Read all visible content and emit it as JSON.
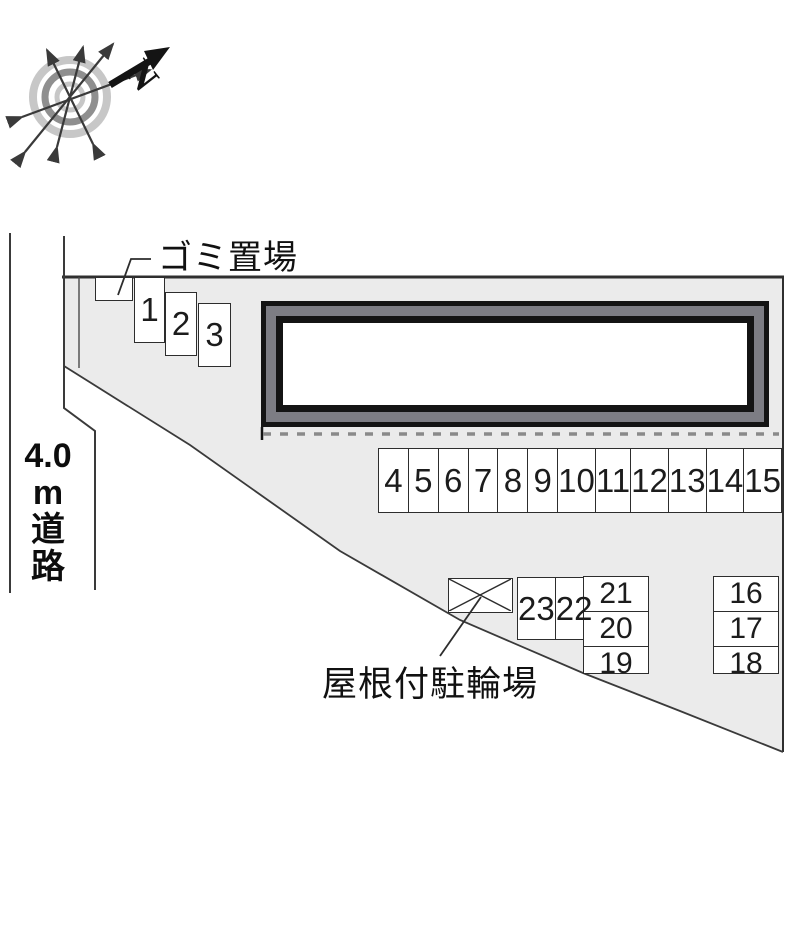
{
  "diagram": {
    "compass": {
      "north_label": "N"
    },
    "road": {
      "label_lines": [
        "4.0",
        "m",
        "道",
        "路"
      ]
    },
    "labels": {
      "garbage": "ゴミ置場",
      "bike_shed": "屋根付駐輪場"
    },
    "parking": {
      "staggered_stalls": [
        {
          "label": "1",
          "x": 134,
          "y": 277,
          "w": 31,
          "h": 66
        },
        {
          "label": "2",
          "x": 165,
          "y": 292,
          "w": 32,
          "h": 64
        },
        {
          "label": "3",
          "x": 198,
          "y": 303,
          "w": 33,
          "h": 64
        }
      ],
      "row_labels": [
        "4",
        "5",
        "6",
        "7",
        "8",
        "9",
        "10",
        "11",
        "12",
        "13",
        "14",
        "15"
      ],
      "right_column_labels": [
        "16",
        "17",
        "18"
      ],
      "mid_column_labels": [
        "21",
        "20",
        "19"
      ],
      "pair_labels": [
        "23",
        "22"
      ]
    },
    "colors": {
      "site_fill": "#ebebeb",
      "boundary_line": "#3a3a3a",
      "building_band": "#7d7d84",
      "dashed_line": "#8a8a8a",
      "compass_ring_light": "#c7c7c7",
      "compass_ring_dark": "#8f8f8f"
    }
  }
}
